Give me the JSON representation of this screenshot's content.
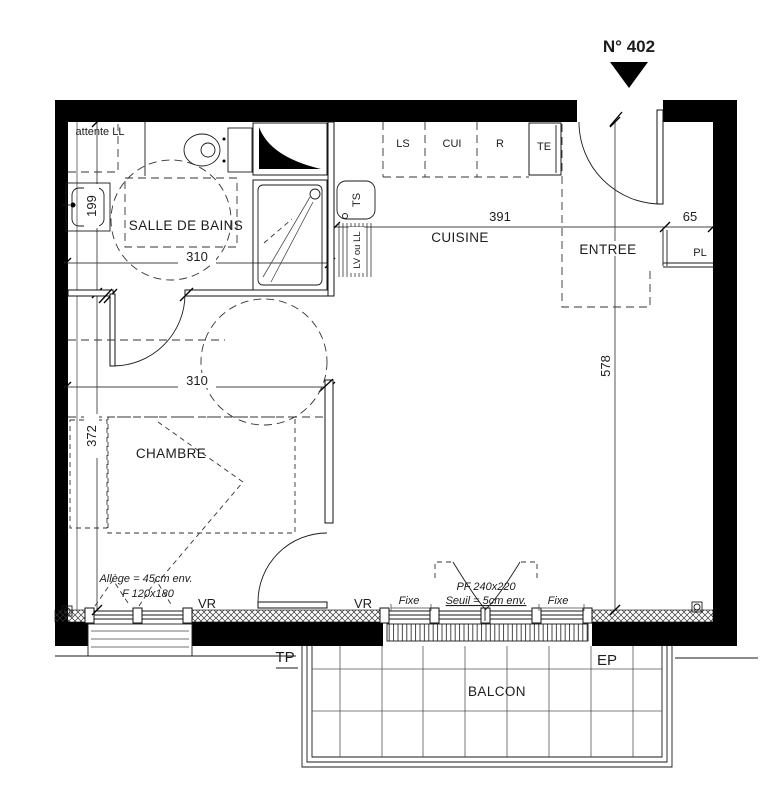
{
  "plan": {
    "unit": "N° 402",
    "rooms": {
      "bathroom": "SALLE DE BAINS",
      "kitchen": "CUISINE",
      "entry": "ENTREE",
      "bedroom": "CHAMBRE",
      "balcony": "BALCON"
    },
    "dims": {
      "bathroom_width": "310",
      "hall_width": "310",
      "kitchen_width": "391",
      "closet_depth": "65",
      "bathroom_side": "199",
      "bedroom_side": "372",
      "right_side": "578"
    },
    "kitchen": {
      "ls": "LS",
      "cui": "CUI",
      "r": "R",
      "te": "TE",
      "ts": "TS",
      "lv": "LV ou LL"
    },
    "labels": {
      "attente": "attente LL",
      "pl": "PL",
      "vr_left": "VR",
      "vr_right": "VR",
      "fixe_left": "Fixe",
      "fixe_right": "Fixe",
      "allege": "Allège = 45cm env.",
      "window_f": "F 120x180",
      "pf": "PF 240x220",
      "seuil": "Seuil = 5cm env.",
      "tp": "TP",
      "ep": "EP"
    }
  }
}
